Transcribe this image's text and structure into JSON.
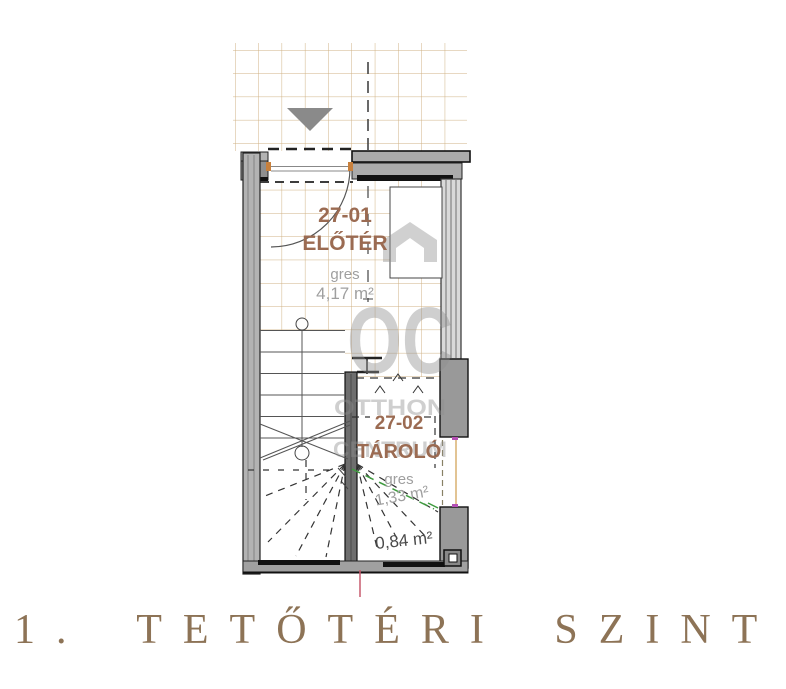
{
  "title": "1. TETŐTÉRI SZINT",
  "watermark": {
    "logo": "OC",
    "line1": "OTTHON",
    "line2": "CENTRUM"
  },
  "rooms": [
    {
      "id": "27-01",
      "name": "ELŐTÉR",
      "flooring": "gres",
      "area": "4,17 m²"
    },
    {
      "id": "27-02",
      "name": "TÁROLÓ",
      "flooring": "gres",
      "area": "1,33 m²"
    }
  ],
  "annotations": {
    "low_headroom_area": "0,84 m²"
  },
  "colors": {
    "room_label": "#9b6b52",
    "measure_label": "#9f9f9f",
    "tile_line": "#cfb183",
    "title_text": "#8d7356",
    "wall_fill": "#a8a8a8",
    "accent_green": "#3f9b3f",
    "accent_magenta": "#b44fb4",
    "accent_red": "#c75b6e",
    "accent_orange": "#c8803c"
  }
}
